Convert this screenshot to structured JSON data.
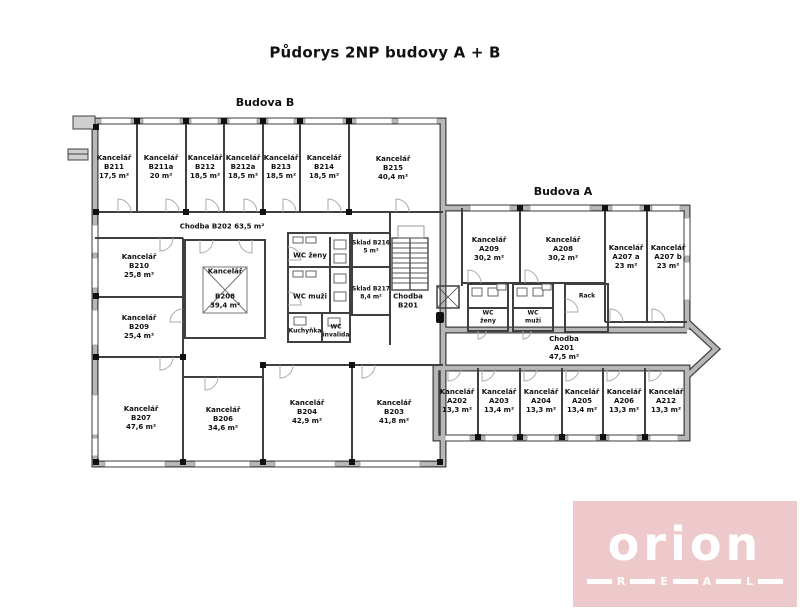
{
  "title": "Půdorys 2NP budovy A + B",
  "buildings": {
    "b_label": "Budova B",
    "a_label": "Budova A"
  },
  "rooms": {
    "b211": {
      "type": "Kancelář",
      "code": "B211",
      "area": "17,5 m²"
    },
    "b211a": {
      "type": "Kancelář",
      "code": "B211a",
      "area": "20 m²"
    },
    "b212": {
      "type": "Kancelář",
      "code": "B212",
      "area": "18,5 m²"
    },
    "b212a": {
      "type": "Kancelář",
      "code": "B212a",
      "area": "18,5 m²"
    },
    "b213": {
      "type": "Kancelář",
      "code": "B213",
      "area": "18,5 m²"
    },
    "b214": {
      "type": "Kancelář",
      "code": "B214",
      "area": "18,5 m²"
    },
    "b215": {
      "type": "Kancelář",
      "code": "B215",
      "area": "40,4 m²"
    },
    "b210": {
      "type": "Kancelář",
      "code": "B210",
      "area": "25,8 m²"
    },
    "b209": {
      "type": "Kancelář",
      "code": "B209",
      "area": "25,4 m²"
    },
    "b208": {
      "type": "Kancelář",
      "code": "B208",
      "area": "39,4 m²"
    },
    "b207": {
      "type": "Kancelář",
      "code": "B207",
      "area": "47,6 m²"
    },
    "b206": {
      "type": "Kancelář",
      "code": "B206",
      "area": "34,6 m²"
    },
    "b204": {
      "type": "Kancelář",
      "code": "B204",
      "area": "42,9 m²"
    },
    "b203": {
      "type": "Kancelář",
      "code": "B203",
      "area": "41,8 m²"
    },
    "a209": {
      "type": "Kancelář",
      "code": "A209",
      "area": "30,2 m²"
    },
    "a208": {
      "type": "Kancelář",
      "code": "A208",
      "area": "30,2 m²"
    },
    "a207a": {
      "type": "Kancelář",
      "code": "A207 a",
      "area": "23 m²"
    },
    "a207b": {
      "type": "Kancelář",
      "code": "A207 b",
      "area": "23 m²"
    },
    "a202": {
      "type": "Kancelář",
      "code": "A202",
      "area": "13,3 m²"
    },
    "a203": {
      "type": "Kancelář",
      "code": "A203",
      "area": "13,4 m²"
    },
    "a204": {
      "type": "Kancelář",
      "code": "A204",
      "area": "13,3 m²"
    },
    "a205": {
      "type": "Kancelář",
      "code": "A205",
      "area": "13,4 m²"
    },
    "a206": {
      "type": "Kancelář",
      "code": "A206",
      "area": "13,3 m²"
    },
    "a212": {
      "type": "Kancelář",
      "code": "A212",
      "area": "13,3 m²"
    }
  },
  "corridors": {
    "b202": {
      "text": "Chodba B202 63,5 m²"
    },
    "b201": {
      "line1": "Chodba",
      "line2": "B201"
    },
    "a201": {
      "line1": "Chodba",
      "line2": "A201",
      "area": "47,5 m²"
    }
  },
  "facilities": {
    "wc_zeny_b": "WC ženy",
    "wc_muzi_b": "WC muži",
    "kuchynka": "Kuchyňka",
    "wc_invalida": {
      "line1": "WC",
      "line2": "invalida"
    },
    "sklad_b216": {
      "line1": "Sklad B216",
      "line2": "5 m²"
    },
    "sklad_b217": {
      "line1": "Sklad B217",
      "line2": "8,4 m²"
    },
    "wc_zeny_a": {
      "line1": "WC",
      "line2": "ženy"
    },
    "wc_muzi_a": {
      "line1": "WC",
      "line2": "muži"
    },
    "rack": "Rack"
  },
  "logo": {
    "brand": "orion",
    "letters": [
      "R",
      "E",
      "A",
      "L"
    ],
    "bg_color": "#eec9cb",
    "text_color": "#ffffff"
  }
}
